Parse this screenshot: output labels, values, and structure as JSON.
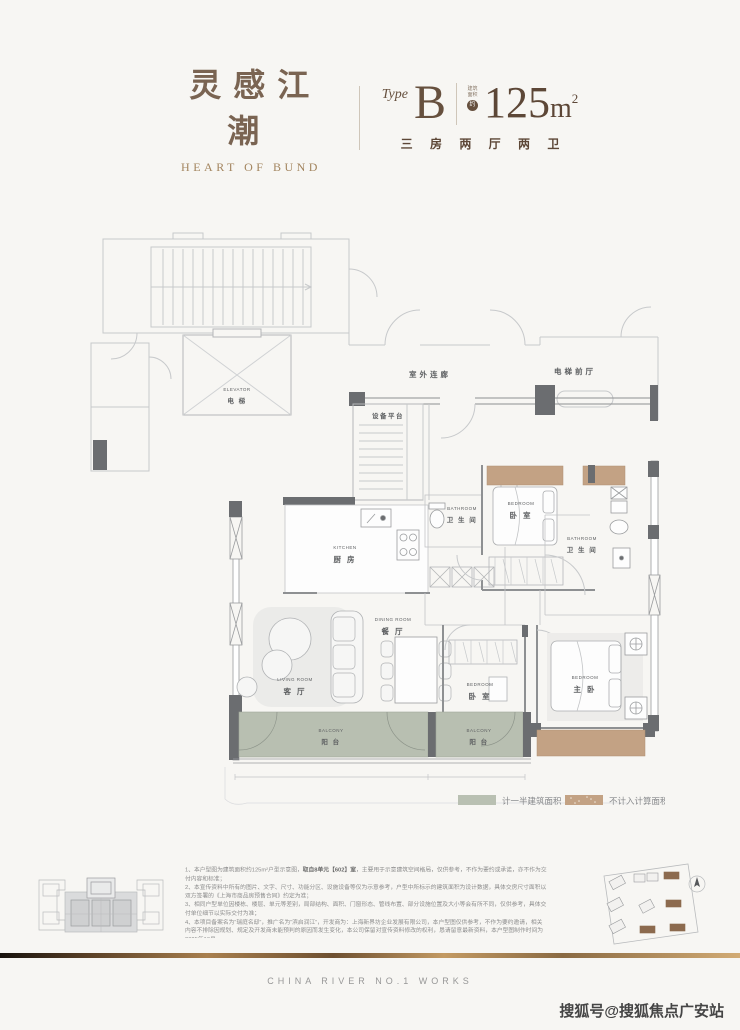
{
  "header": {
    "brand_cn": "灵感江潮",
    "brand_en": "HEART OF BUND",
    "type_label": "Type",
    "type_value": "B",
    "area_prefix_line1": "建筑",
    "area_prefix_line2": "面积",
    "area_approx": "约",
    "area_number": "125",
    "area_unit": "m",
    "area_exponent": "2",
    "rooms_desc": "三 房 两 厅 两 卫"
  },
  "floorplan": {
    "labels": {
      "outdoor_corridor": "室外连廊",
      "elevator_hall": "电梯前厅",
      "equipment_platform": "设备平台",
      "elevator_en": "ELEVATOR",
      "elevator_cn": "电 梯",
      "kitchen_en": "KITCHEN",
      "kitchen_cn": "厨 房",
      "bathroom1_en": "BATHROOM",
      "bathroom1_cn": "卫 生 间",
      "bathroom2_en": "BATHROOM",
      "bathroom2_cn": "卫 生 间",
      "bedroom2_en": "BEDROOM",
      "bedroom2_cn": "卧 室",
      "bedroom3_en": "BEDROOM",
      "bedroom3_cn": "卧 室",
      "master_en": "BEDROOM",
      "master_cn": "主 卧",
      "dining_en": "DINING ROOM",
      "dining_cn": "餐 厅",
      "living_en": "LIVING ROOM",
      "living_cn": "客 厅",
      "balcony1_en": "BALCONY",
      "balcony1_cn": "阳 台",
      "balcony2_en": "BALCONY",
      "balcony2_cn": "阳 台"
    },
    "legend": [
      {
        "label": "计一半建筑面积",
        "color": "#b9c0b2"
      },
      {
        "label": "不计入计算面积",
        "color": "#c3a284"
      }
    ]
  },
  "notes": {
    "item1_pre": "1、本户型图为建筑面积约125m²户型示意图，",
    "item1_bold": "取自8单元【602】室",
    "item1_post": "，主要用于示意建筑空间格局，仅供参考，不作为要约或承诺，亦不作为交付内容和标准；",
    "item2": "2、本宣传资料中所有的图片、文字、尺寸、功能分区、设施设备等仅为示意参考，户型中所标示的建筑面积为设计数据，具体交房尺寸面积以双方签署的《上海市商品房预售合同》约定为准；",
    "item3": "3、相同户型单位因楼栋、楼层、单元等差别，局部结构、面积、门窗形态、管线布置、部分设施位置及大小等会有所不同，仅供参考，具体交付单位细节以实际交付为准；",
    "item4": "4、本项目备案名为“瑞庭名邸”，推广名为“滨启润江”，开发商为：上海新界坊企业发展有限公司，本户型图仅供参考，不作为要约邀请，相关内容不排除因规划、规定及开发商未能预判的原因而发生变化，本公司保留对宣传资料修改的权利，恳请留意最新资料，本户型图制作时间为2025年10月。"
  },
  "footer": {
    "caption": "CHINA RIVER NO.1 WORKS",
    "watermark": "搜狐号@搜狐焦点广安站"
  },
  "colors": {
    "accent_brown": "#66503e",
    "balcony_green": "#b8bfb1",
    "bay_tan": "#c3a284",
    "wall_dark": "#6b6d70"
  }
}
